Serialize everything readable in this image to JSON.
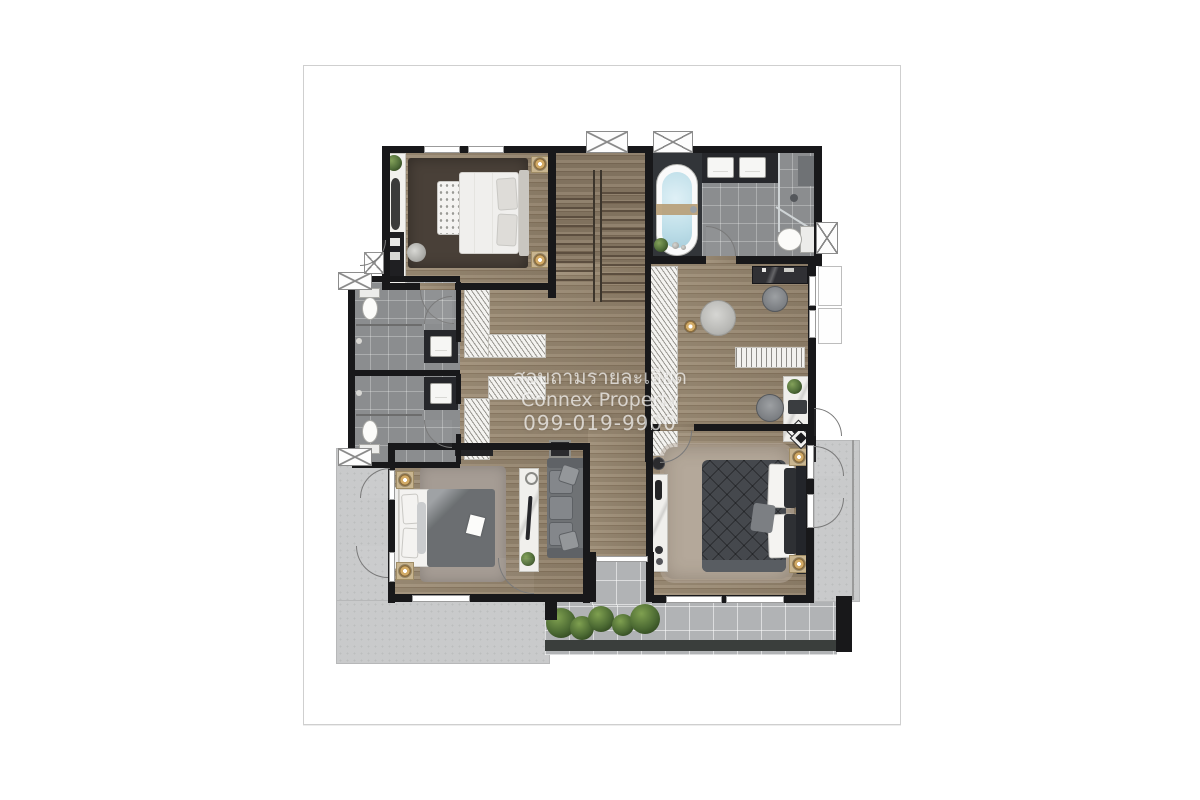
{
  "watermark": {
    "line1": "สอบถามรายละเอียด",
    "line2": "Connex Property",
    "line3": "099-019-9900"
  },
  "palette": {
    "page_background": "#ffffff",
    "page_border": "#cfcfcf",
    "wall": "#18181a",
    "wood_floor": "#9a8971",
    "stair_wood": "#8b7b66",
    "bath_tile": "#8b8d8f",
    "bath_dark_zone": "#323539",
    "balcony_tile": "#b1b3b5",
    "terrace_concrete": "#c9cacb",
    "tub_water": "#bfdfe9",
    "gold_lamp": "#d3ab66",
    "plant_green": "#506d39",
    "master_duvet": "#45484d",
    "watermark_text": "rgba(255,255,255,0.68)"
  },
  "plan": {
    "type": "second-floor residential floor plan, top-down render",
    "rooms": [
      {
        "name": "bedroom-top-left",
        "fixtures": [
          "double-bed-white",
          "foot-bench",
          "nightstands-with-lamps",
          "dark-rug",
          "tv-console",
          "dresser",
          "stool",
          "plant"
        ]
      },
      {
        "name": "staircase",
        "fixtures": [
          "double-run-stairs",
          "center-rail",
          "window"
        ]
      },
      {
        "name": "master-bathroom-top-right",
        "fixtures": [
          "freestanding-bathtub",
          "double-vanity-sinks",
          "walk-in-shower",
          "toilet",
          "windows"
        ]
      },
      {
        "name": "bathroom-left-upper",
        "fixtures": [
          "toilet",
          "vanity-sink",
          "shower",
          "window"
        ]
      },
      {
        "name": "bathroom-left-lower",
        "fixtures": [
          "toilet",
          "vanity-sink",
          "shower",
          "window"
        ]
      },
      {
        "name": "walk-in-closets",
        "fixtures": [
          "hanging-rails-upper",
          "hanging-rails-lower",
          "tall-wardrobe"
        ]
      },
      {
        "name": "family-area-right",
        "fixtures": [
          "round-pouf",
          "bookshelf",
          "desk-with-laptop",
          "desk-chair",
          "dressing-counter",
          "chair",
          "diamond-mat"
        ]
      },
      {
        "name": "bedroom-bottom-left",
        "fixtures": [
          "double-bed-gray",
          "gray-rug",
          "nightstand-lamps",
          "console-table",
          "sofa",
          "tv-cabinet"
        ]
      },
      {
        "name": "master-bedroom-bottom-right",
        "fixtures": [
          "king-bed-tufted-dark",
          "shaggy-rug",
          "nightstands-with-lamps",
          "console-shelf",
          "diamond-mat"
        ]
      },
      {
        "name": "outdoor",
        "fixtures": [
          "left-terrace",
          "bottom-balcony-tiles",
          "planter-with-bushes",
          "right-balcony",
          "column"
        ]
      }
    ]
  }
}
